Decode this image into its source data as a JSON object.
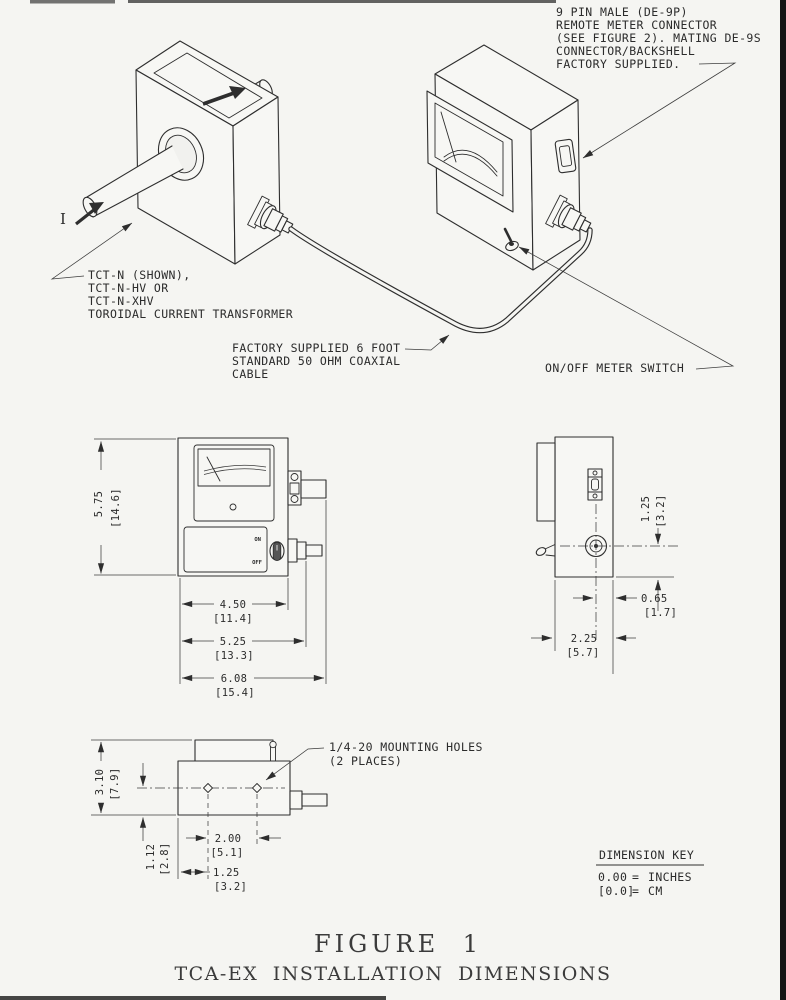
{
  "page": {
    "bg": "#f5f5f2",
    "ink": "#2e2e2e",
    "edge": "#151515"
  },
  "iso": {
    "current_label": "I",
    "transformer_note": {
      "lines": [
        "TCT-N (SHOWN),",
        "TCT-N-HV OR",
        "TCT-N-XHV",
        "TOROIDAL CURRENT TRANSFORMER"
      ]
    },
    "connector_note": {
      "lines": [
        "9 PIN MALE (DE-9P)",
        "REMOTE METER CONNECTOR",
        "(SEE FIGURE 2). MATING DE-9S",
        "CONNECTOR/BACKSHELL",
        "FACTORY SUPPLIED."
      ]
    },
    "cable_note": {
      "lines": [
        "FACTORY SUPPLIED 6 FOOT",
        "STANDARD 50 OHM COAXIAL",
        "CABLE"
      ]
    },
    "switch_note": "ON/OFF METER SWITCH"
  },
  "front_view": {
    "switch_on": "ON",
    "switch_off": "OFF",
    "dim_height_in": "5.75",
    "dim_height_cm": "[14.6]",
    "dim_w1_in": "4.50",
    "dim_w1_cm": "[11.4]",
    "dim_w2_in": "5.25",
    "dim_w2_cm": "[13.3]",
    "dim_w3_in": "6.08",
    "dim_w3_cm": "[15.4]"
  },
  "side_view": {
    "dim_bnc_in": "1.25",
    "dim_bnc_cm": "[3.2]",
    "dim_offset_in": "0.65",
    "dim_offset_cm": "[1.7]",
    "dim_depth_in": "2.25",
    "dim_depth_cm": "[5.7]"
  },
  "bottom_view": {
    "mounting_note": {
      "lines": [
        "1/4-20 MOUNTING HOLES",
        "(2 PLACES)"
      ]
    },
    "dim_depth_in": "3.10",
    "dim_depth_cm": "[7.9]",
    "dim_edge_in": "1.12",
    "dim_edge_cm": "[2.8]",
    "dim_spacing_in": "2.00",
    "dim_spacing_cm": "[5.1]",
    "dim_end_in": "1.25",
    "dim_end_cm": "[3.2]"
  },
  "dimension_key": {
    "title": "DIMENSION KEY",
    "rows": [
      {
        "code": "0.00",
        "equals": "=",
        "unit": "INCHES"
      },
      {
        "code": "[0.0]",
        "equals": "=",
        "unit": "CM"
      }
    ]
  },
  "figure": {
    "title": "FIGURE 1",
    "subtitle": "TCA-EX INSTALLATION DIMENSIONS"
  }
}
